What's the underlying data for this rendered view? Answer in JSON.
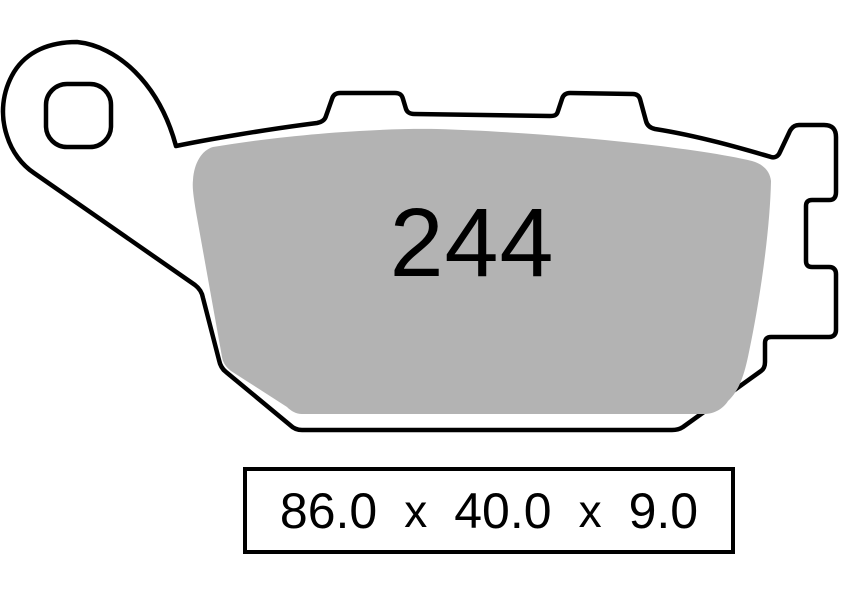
{
  "diagram": {
    "pad_number": "244",
    "dimensions": {
      "label": "86.0 x 40.0 x 9.0",
      "parts": [
        "86.0",
        "x",
        "40.0",
        "x",
        "9.0"
      ],
      "width_mm": "86.0",
      "height_mm": "40.0",
      "thickness_mm": "9.0"
    },
    "colors": {
      "outline": "#000000",
      "friction_material": "#b3b3b3",
      "backplate_fill": "#ffffff",
      "background": "#ffffff"
    }
  }
}
